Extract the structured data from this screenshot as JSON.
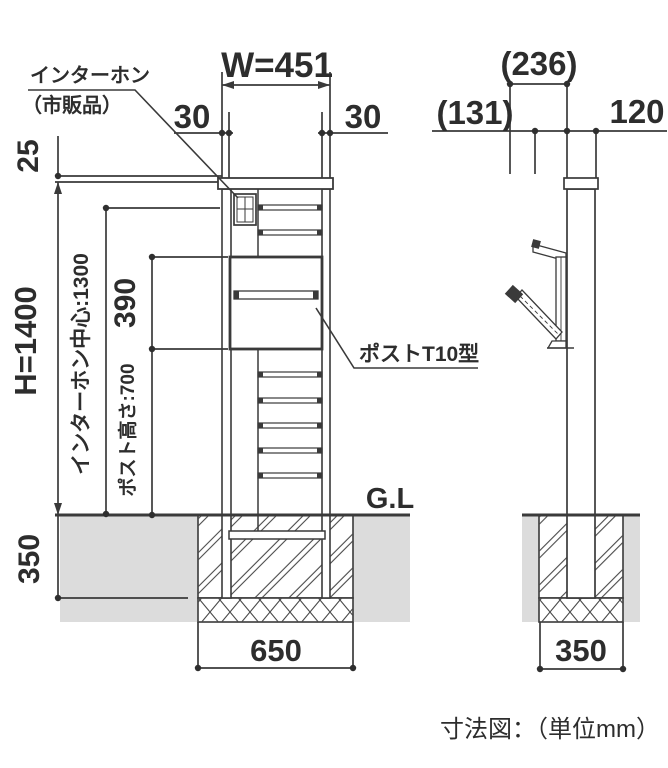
{
  "diagram": {
    "caption": "寸法図：（単位mm）",
    "colors": {
      "ink": "#3a3a3a",
      "ground_fill": "#dcdcdc"
    },
    "front_view": {
      "labels": {
        "intercom_line1": "インターホン",
        "intercom_line2": "（市販品）",
        "post_model": "ポストT10型",
        "ground_level": "G.L"
      },
      "dims": {
        "top_width": "W=451",
        "side_offset_left": "30",
        "side_offset_right": "30",
        "cap": "25",
        "height": "H=1400",
        "intercom_center_height": "インターホン中心:1300",
        "post_opening_height": "390",
        "post_height": "ポスト高さ:700",
        "embed_depth": "350",
        "footing_width": "650"
      }
    },
    "side_view": {
      "dims": {
        "overall_depth": "(236)",
        "front_overhang": "(131)",
        "post_depth": "120",
        "footing_width": "350"
      }
    }
  }
}
